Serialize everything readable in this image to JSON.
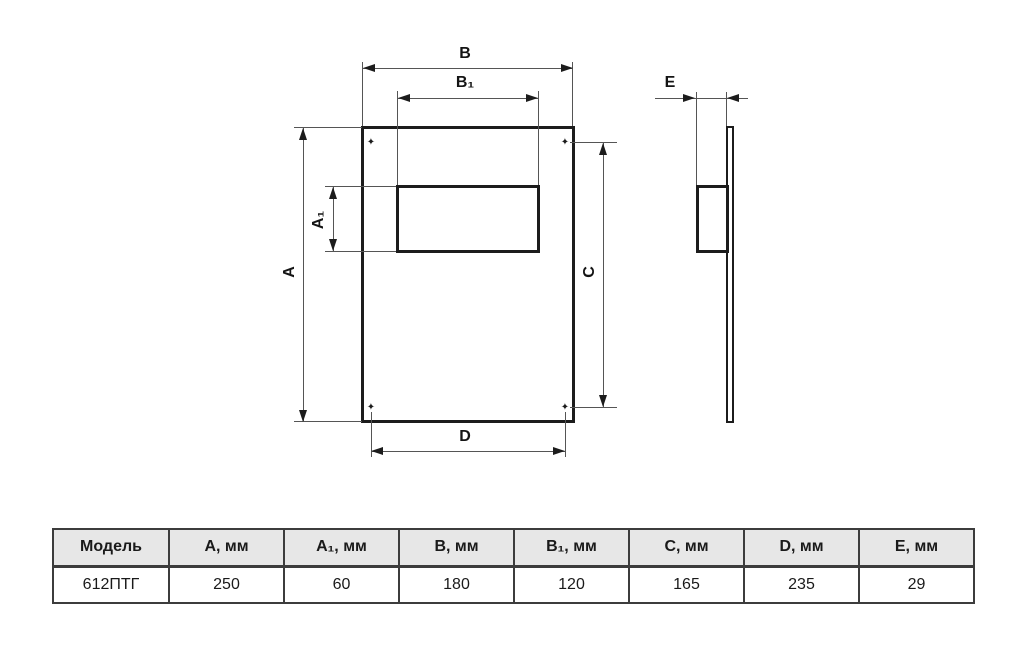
{
  "drawing": {
    "front_view": {
      "dim_B": "B",
      "dim_B1": "B₁",
      "dim_A": "A",
      "dim_A1": "A₁",
      "dim_C": "C",
      "dim_D": "D"
    },
    "side_view": {
      "dim_E": "E"
    },
    "hole_marker": "✦"
  },
  "table": {
    "headers": [
      "Модель",
      "А, мм",
      "А₁, мм",
      "В, мм",
      "В₁, мм",
      "С, мм",
      "D, мм",
      "Е, мм"
    ],
    "rows": [
      [
        "612ПТГ",
        "250",
        "60",
        "180",
        "120",
        "165",
        "235",
        "29"
      ]
    ]
  },
  "colors": {
    "background": "#ffffff",
    "outline": "#1c1c1c",
    "dim_line": "#555555",
    "table_border": "#3c3c3c",
    "table_header_bg": "#e7e7e7"
  }
}
